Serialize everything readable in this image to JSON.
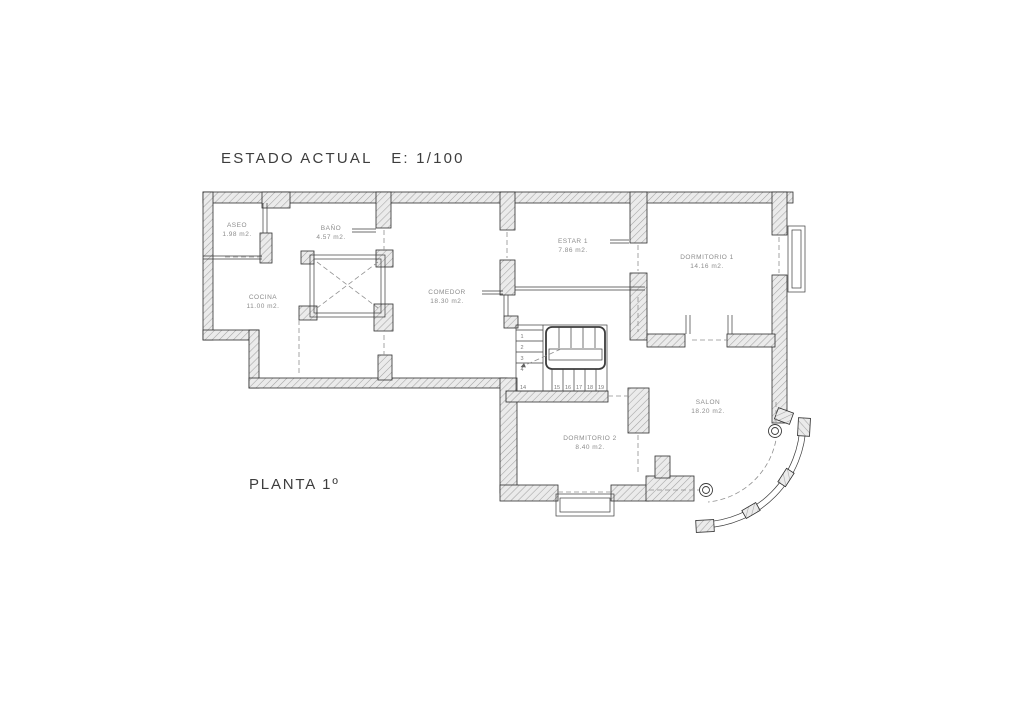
{
  "header": {
    "title": "ESTADO ACTUAL   E: 1/100"
  },
  "footer": {
    "floor_label": "PLANTA 1º"
  },
  "rooms": {
    "aseo": {
      "name": "ASEO",
      "area": "1.98 m2."
    },
    "bano": {
      "name": "BAÑO",
      "area": "4.57 m2."
    },
    "cocina": {
      "name": "COCINA",
      "area": "11.00 m2."
    },
    "comedor": {
      "name": "COMEDOR",
      "area": "18.30 m2."
    },
    "estar1": {
      "name": "ESTAR 1",
      "area": "7.86 m2."
    },
    "dormitorio1": {
      "name": "DORMITORIO 1",
      "area": "14.16 m2."
    },
    "salon": {
      "name": "SALON",
      "area": "18.20 m2."
    },
    "dormitorio2": {
      "name": "DORMITORIO 2",
      "area": "8.40 m2."
    }
  },
  "stairs": {
    "flight_up_numbers": [
      "1",
      "2",
      "3",
      "4"
    ],
    "flight_lower_numbers": [
      "14",
      "15",
      "16",
      "17",
      "18",
      "19"
    ]
  },
  "colors": {
    "wall_fill": "#ebebeb",
    "hatch_line": "#a3a3a3",
    "wall_outline": "#2e2e2e",
    "room_label_text": "#8c8c8c",
    "title_text": "#3d3d3d"
  }
}
